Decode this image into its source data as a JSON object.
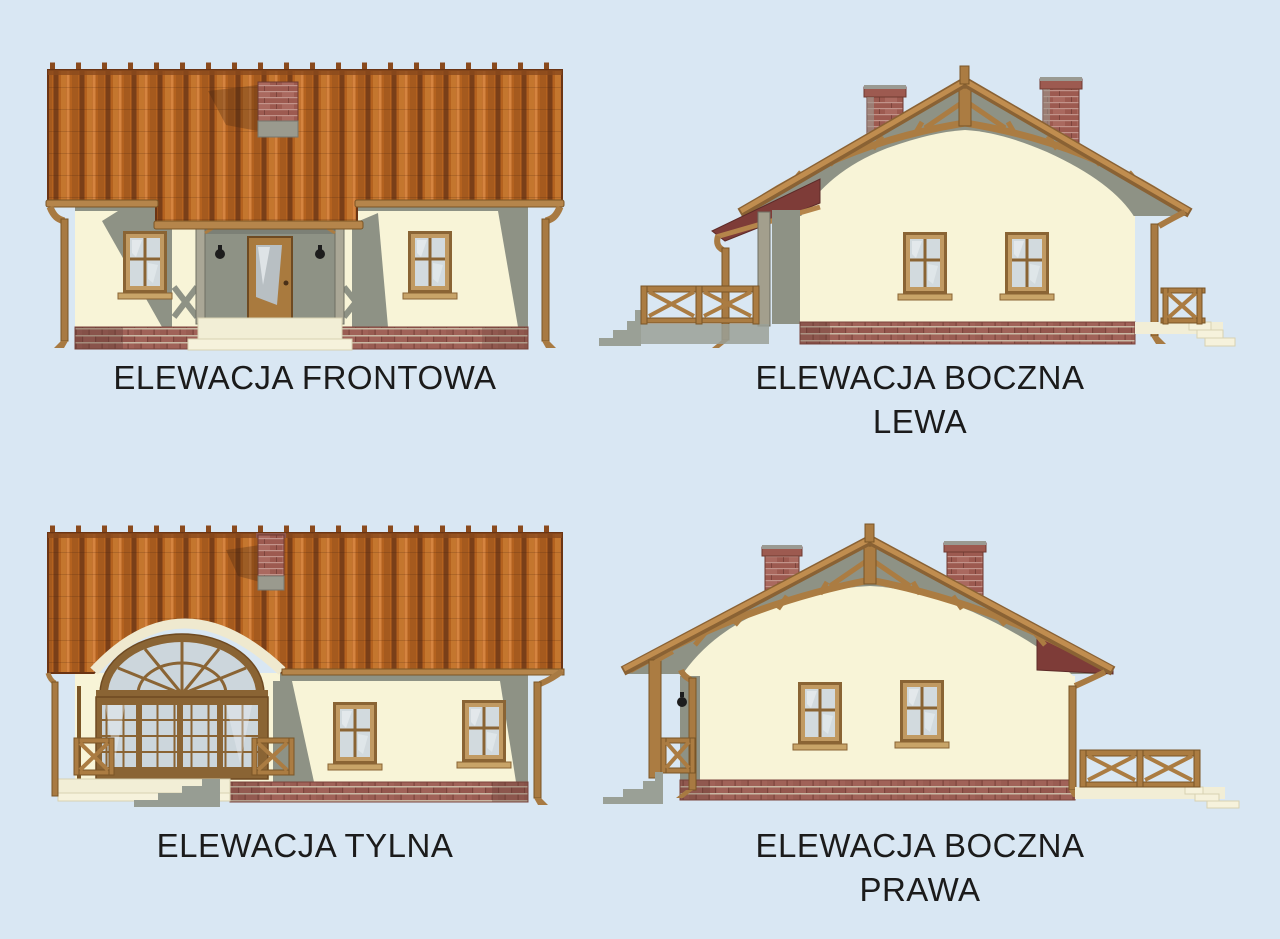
{
  "sheet": {
    "background_color": "#d9e7f3",
    "label_color": "#1b1b1b"
  },
  "palette": {
    "roof_tile": "#b4621f",
    "roof_tile_dark": "#7a3f18",
    "roof_tile_light": "#d58440",
    "roof_edge": "#6b3413",
    "porch_roof_maroon": "#7e3c38",
    "wall_cream": "#f8f4d7",
    "shadow_gray": "#8e9285",
    "brick_base": "#a06258",
    "brick_mortar": "#c9b8a4",
    "chimney_brick": "#9d5a50",
    "wood_trim": "#ab7c42",
    "wood_trim_dark": "#7a5526",
    "window_frame": "#8a6434",
    "glass": "#d2dade",
    "steps_gray": "#9aa096",
    "terrace_floor": "#f2eed6"
  },
  "elevations": [
    {
      "id": "front",
      "label_line1": "ELEWACJA FRONTOWA",
      "label_line2": ""
    },
    {
      "id": "side-left",
      "label_line1": "ELEWACJA BOCZNA",
      "label_line2": "LEWA"
    },
    {
      "id": "rear",
      "label_line1": "ELEWACJA TYLNA",
      "label_line2": ""
    },
    {
      "id": "side-right",
      "label_line1": "ELEWACJA BOCZNA",
      "label_line2": "PRAWA"
    }
  ]
}
